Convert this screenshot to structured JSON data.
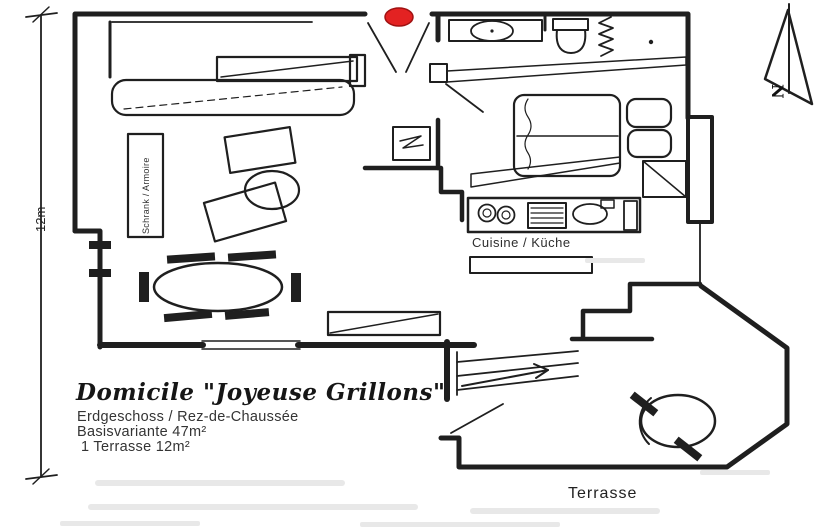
{
  "title_block": {
    "title": "Domicile \"Joyeuse Grillons\"",
    "line1": "Erdgeschoss / Rez-de-Chaussée",
    "line2": "Basisvariante 47m²",
    "line3": "1 Terrasse 12m²"
  },
  "labels": {
    "kitchen": "Cuisine / Küche",
    "terrace": "Terrasse",
    "wardrobe": "Schrank / Armoire",
    "dimension_left": "12m",
    "compass_north": "N"
  },
  "colors": {
    "ink": "#1f1f1f",
    "entrance_marker_fill": "#e32222",
    "entrance_marker_stroke": "#a01111",
    "paper": "#ffffff",
    "scan_artifact": "#e8e8e8"
  }
}
